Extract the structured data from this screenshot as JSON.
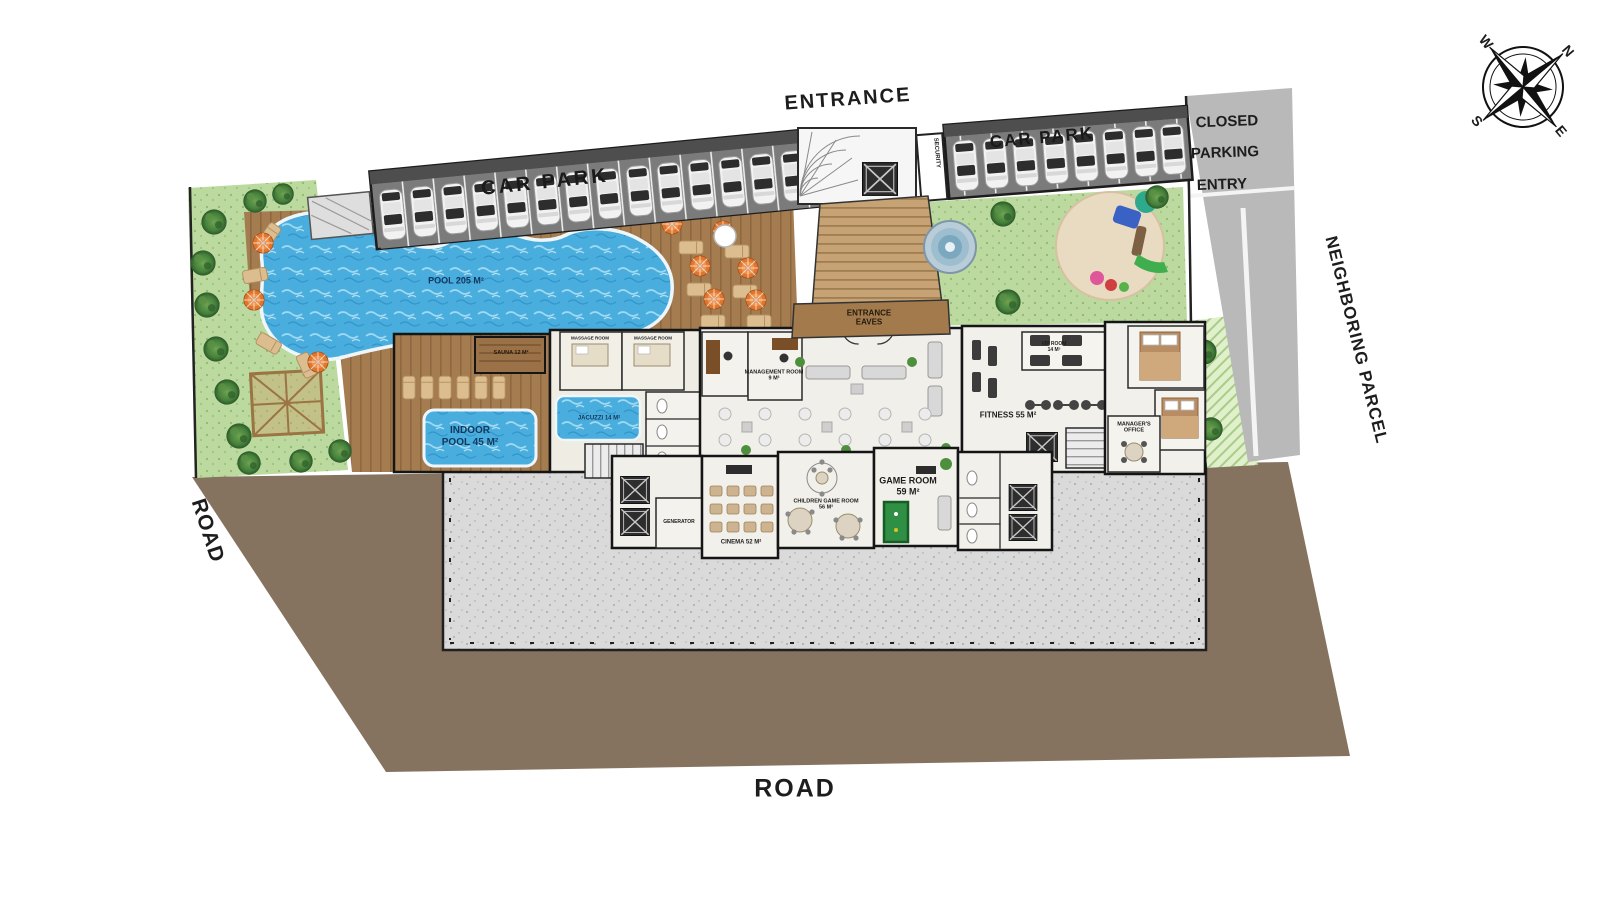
{
  "title": "Residential complex ground floor site plan",
  "labels": {
    "entrance": "ENTRANCE",
    "car_park_left": "CAR PARK",
    "car_park_right": "CAR PARK",
    "closed": "CLOSED",
    "parking": "PARKING",
    "entry": "ENTRY",
    "neighboring_parcel": "NEIGHBORING PARCEL",
    "road_left": "ROAD",
    "road_bottom": "ROAD",
    "security": "SECURITY",
    "pool": "POOL 205 M²",
    "indoor_pool_1": "INDOOR",
    "indoor_pool_2": "POOL 45 M²",
    "sauna": "SAUNA 12 M²",
    "jacuzzi": "JACUZZI 14 M²",
    "massage_1": "MASSAGE ROOM",
    "massage_2": "MASSAGE ROOM",
    "management_1": "MANAGEMENT ROOM",
    "management_2": "9 M²",
    "entrance_eaves_1": "ENTRANCE",
    "entrance_eaves_2": "EAVES",
    "game_room_1": "GAME ROOM",
    "game_room_2": "59 M²",
    "cinema": "CINEMA 52 M²",
    "children_1": "CHILDREN GAME ROOM",
    "children_2": "56 M²",
    "fitness": "FITNESS 55 M²",
    "vip_1": "VIP ROOM",
    "vip_2": "14 M²",
    "managers_office_1": "MANAGER'S",
    "managers_office_2": "OFFICE",
    "generator": "GENERATOR",
    "compass": {
      "n": "N",
      "e": "E",
      "s": "S",
      "w": "W"
    }
  },
  "colors": {
    "pool_blue": "#49aede",
    "lawn_green": "#bcd9a0",
    "tree_green": "#35682f",
    "deck_wood": "#a57c50",
    "asphalt": "#7b7b7b",
    "ground_brown": "#85735f",
    "terrace_gray": "#dadada",
    "parasol_orange": "#e0762c",
    "wall_black": "#1a1a1a"
  }
}
